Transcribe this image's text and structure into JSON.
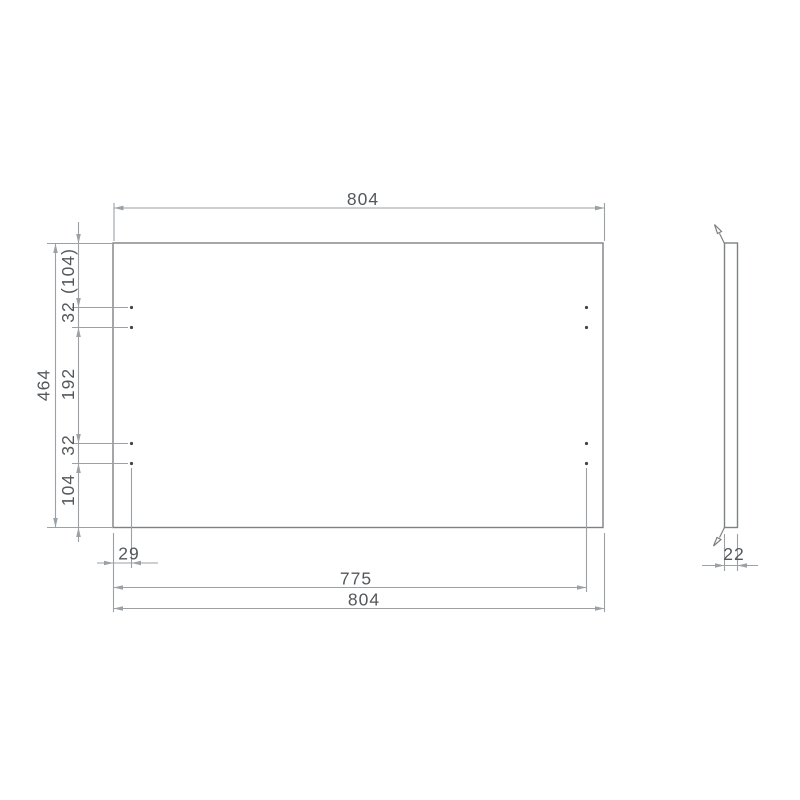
{
  "drawing": {
    "type": "panel-dimension-drawing",
    "colors": {
      "background": "#ffffff",
      "edge_line": "#7d8184",
      "dimension_line": "#9ba1a5",
      "text": "#54585b",
      "hole_dot": "#43474a"
    },
    "front_view": {
      "top_width_label": "804",
      "overall_height_label": "464",
      "left_chain": {
        "top_margin_ref": "(104)",
        "hole_pitch_top": "32",
        "middle_span": "192",
        "hole_pitch_bottom": "32",
        "bottom_margin": "104"
      },
      "bottom": {
        "hole_edge_offset": "29",
        "hole_column_span": "775",
        "overall_width": "804"
      }
    },
    "side_view": {
      "thickness_label": "22"
    }
  }
}
